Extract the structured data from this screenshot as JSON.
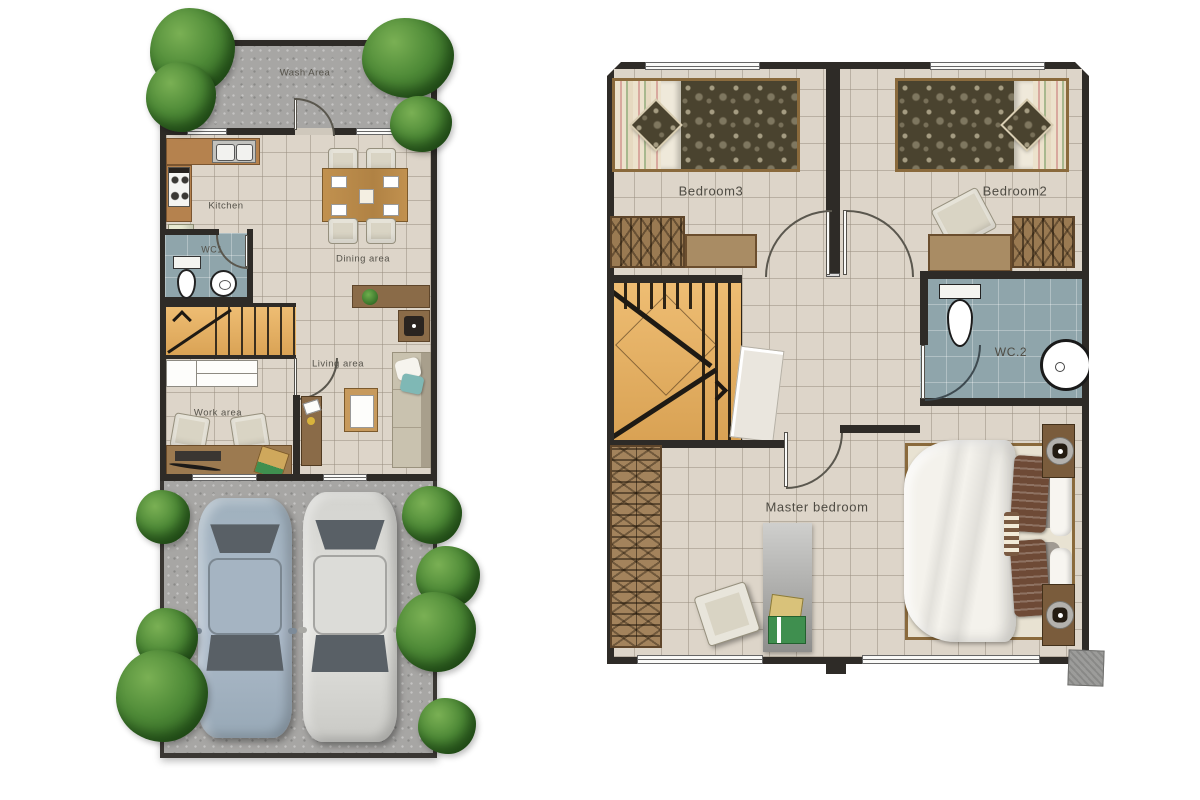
{
  "ground_floor": {
    "labels": {
      "wash_area": "Wash Area",
      "kitchen": "Kitchen",
      "wc1": "WC1",
      "dining_area": "Dining area",
      "living_area": "Living area",
      "work_area": "Work area"
    }
  },
  "upper_floor": {
    "labels": {
      "bedroom3": "Bedroom3",
      "bedroom2": "Bedroom2",
      "wc2": "WC.2",
      "master_bedroom": "Master bedroom"
    }
  },
  "colors": {
    "wall": "#2e2b27",
    "floor_tile": "#ddd5c9",
    "concrete": "#a7a6a4",
    "bathroom_floor": "#8fa5ab",
    "wood": "#e2ac63",
    "furniture_brown": "#9a7a52",
    "tree_green": "#4e8a37"
  }
}
